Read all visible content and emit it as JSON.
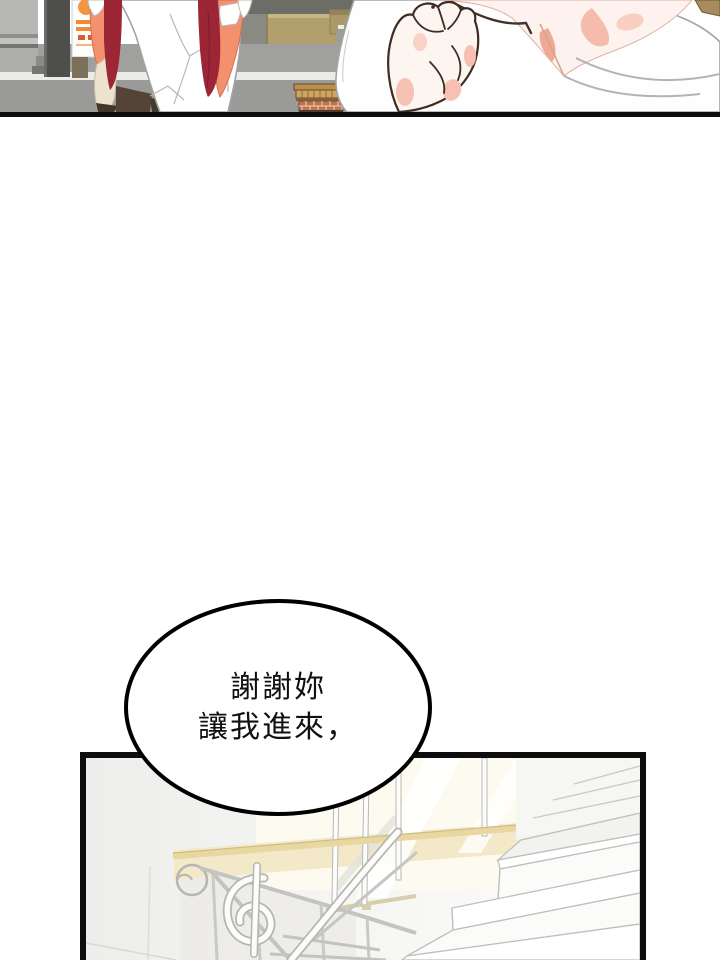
{
  "page": {
    "kind": "comic-page",
    "background": "#ffffff",
    "panel_border_color": "#0d0d0d"
  },
  "speech_bubble": {
    "lines": [
      "謝謝妳",
      "讓我進來，"
    ],
    "full_text": "謝謝妳 讓我進來，",
    "text_color": "#111111",
    "outline_color": "#000000",
    "fill_color": "#ffffff"
  },
  "palette": {
    "maroon_cardigan": "#9c2636",
    "salmon_sleeve": "#f3906d",
    "forearm_skin": "#ece2cd",
    "closeup_skin": "#fdf2ed",
    "blush_pink": "#f5bcae",
    "shorts_brown": "#544438",
    "bench_wood": "#cfa65f",
    "bench_brick": "#c0714e",
    "tan_wall": "#b1a06e",
    "ground_gray": "#9a9a98",
    "pillar_gray": "#4e4e4c",
    "poster_orange": "#f49540",
    "stair_glow": "#f3e9c8",
    "outline_gray": "#a3a3a1",
    "ink_outline": "#3d2b24"
  }
}
